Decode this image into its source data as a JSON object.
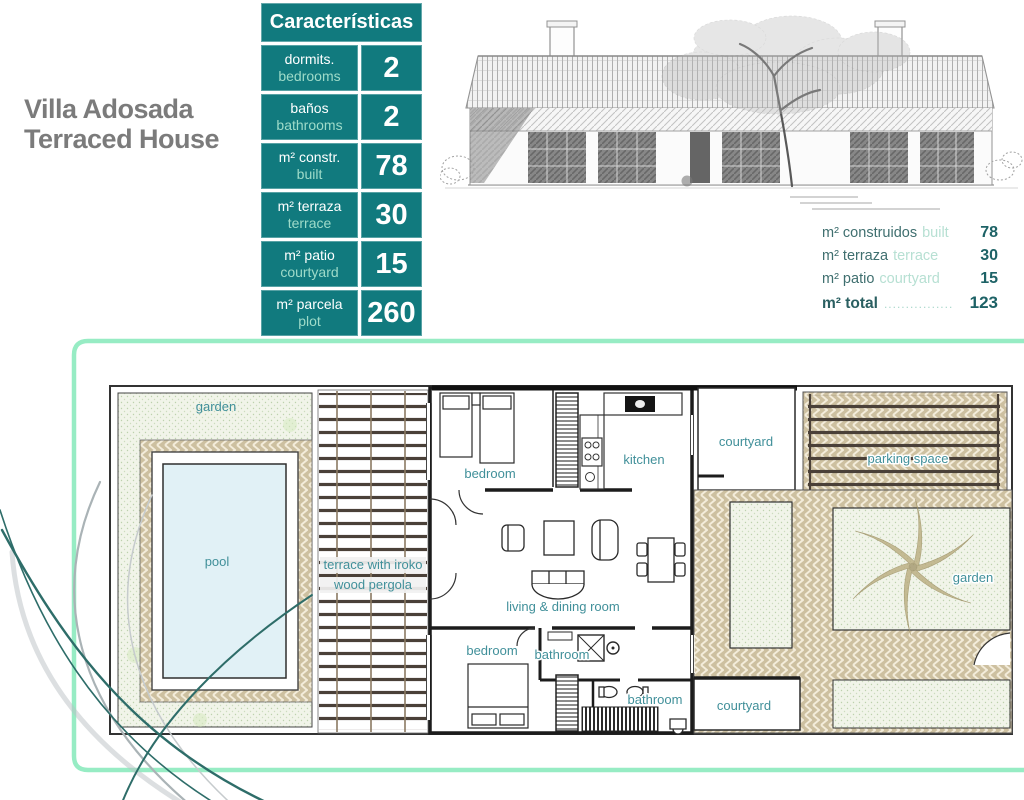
{
  "title": {
    "line1": "Villa Adosada",
    "line2": "Terraced House"
  },
  "characteristics": {
    "header": "Características",
    "rows": [
      {
        "es": "dormits.",
        "en": "bedrooms",
        "value": "2"
      },
      {
        "es": "baños",
        "en": "bathrooms",
        "value": "2"
      },
      {
        "es": "m² constr.",
        "en": "built",
        "value": "78"
      },
      {
        "es": "m² terraza",
        "en": "terrace",
        "value": "30"
      },
      {
        "es": "m² patio",
        "en": "courtyard",
        "value": "15"
      },
      {
        "es": "m² parcela",
        "en": "plot",
        "value": "260"
      }
    ]
  },
  "summary": {
    "rows": [
      {
        "es": "m² construidos",
        "en": "built",
        "value": "78"
      },
      {
        "es": "m² terraza",
        "en": "terrace",
        "value": "30"
      },
      {
        "es": "m² patio",
        "en": "courtyard",
        "value": "15"
      }
    ],
    "total": {
      "es": "m² total",
      "leader": "................",
      "value": "123"
    }
  },
  "floor_plan": {
    "labels": {
      "garden_left": "garden",
      "pool": "pool",
      "terrace_line1": "terrace with iroko",
      "terrace_line2": "wood pergola",
      "bedroom_top": "bedroom",
      "kitchen": "kitchen",
      "living": "living & dining room",
      "bedroom_bottom": "bedroom",
      "bathroom_1": "bathroom",
      "bathroom_2": "bathroom",
      "courtyard_top": "courtyard",
      "parking": "parking space",
      "garden_right": "garden",
      "courtyard_bottom": "courtyard"
    }
  },
  "colors": {
    "teal": "#117a7e",
    "mint_text": "#9edbc9",
    "label_teal": "#41909a",
    "frame_mint": "#97ecc4",
    "title_gray": "#7b7b7b",
    "summary_dark": "#1d6266",
    "herringbone": "#cdc0a0",
    "pool_fill": "#e1f1f6",
    "garden_fill": "#f1f4e9"
  }
}
